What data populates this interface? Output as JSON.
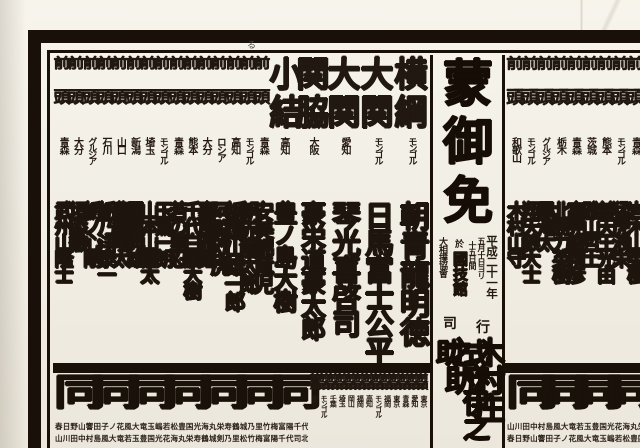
{
  "document": {
    "kind": "sumo-banzuke",
    "corner_mark": "る",
    "reading_order": "columns right-to-left; arrays below are in left-to-right display order"
  },
  "center": {
    "license": [
      "蒙",
      "御",
      "免"
    ],
    "date_line": "平成二十一年",
    "date_sub1": "五月十日ヨリ",
    "date_sub2": "十五日間",
    "venue_prefix": "於",
    "venue": "國技館",
    "organizer": "大相撲協會",
    "gyoji_label_right": "行",
    "gyoji_label_left": "司",
    "gyoji_right": "木村庄之助",
    "gyoji_left": "式守伊之助"
  },
  "west": {
    "side_note": "west half of makuuchi row, lowest rank at left edge",
    "columns": [
      {
        "rank": "前頭",
        "rt": "前",
        "rb": "頭",
        "origin": "青森",
        "name": "武州山隆士"
      },
      {
        "rank": "前頭",
        "rt": "前",
        "rb": "頭",
        "origin": "大分",
        "name": "垣添徹"
      },
      {
        "rank": "前頭",
        "rt": "前",
        "rb": "頭",
        "origin": "グルジア",
        "name": "栃ノ心剛"
      },
      {
        "rank": "前頭",
        "rt": "前",
        "rb": "頭",
        "origin": "石川",
        "name": "栃乃洋泰一"
      },
      {
        "rank": "前頭",
        "rt": "前",
        "rb": "頭",
        "origin": "山口",
        "name": "豊響隆太"
      },
      {
        "rank": "前頭",
        "rt": "前",
        "rb": "頭",
        "origin": "新潟",
        "name": "霜鳳典雄"
      },
      {
        "rank": "前頭",
        "rt": "前",
        "rb": "頭",
        "origin": "埼玉",
        "name": "山本山龍太"
      },
      {
        "rank": "前頭",
        "rt": "前",
        "rb": "頭",
        "origin": "モンゴル",
        "name": "玉鷲一朗"
      },
      {
        "rank": "前頭",
        "rt": "前",
        "rb": "頭",
        "origin": "青森",
        "name": "若の里忍"
      },
      {
        "rank": "前頭",
        "rt": "前",
        "rb": "頭",
        "origin": "熊本",
        "name": "千代白鵬大樹"
      },
      {
        "rank": "前頭",
        "rt": "前",
        "rb": "頭",
        "origin": "大分",
        "name": "嘉風雅継"
      },
      {
        "rank": "前頭",
        "rt": "前",
        "rb": "頭",
        "origin": "ロシア",
        "name": "阿覧欧虎"
      },
      {
        "rank": "前頭",
        "rt": "前",
        "rb": "頭",
        "origin": "高知",
        "name": "栃煌山雄一郎"
      },
      {
        "rank": "前頭",
        "rt": "前",
        "rb": "頭",
        "origin": "モンゴル",
        "name": "朝赤龍太郎"
      },
      {
        "rank": "前頭",
        "rt": "前",
        "rb": "頭",
        "origin": "青森",
        "name": "安美錦竜児"
      },
      {
        "rank": "小結",
        "rt": "小",
        "rb": "結",
        "origin": "高知",
        "name": "豊ノ島大樹"
      },
      {
        "rank": "関脇",
        "rt": "関",
        "rb": "脇",
        "origin": "大阪",
        "name": "豪栄道豪太郎"
      },
      {
        "rank": "大関",
        "rt": "大",
        "rb": "関",
        "origin": "愛知",
        "name": "琴光喜啓司"
      },
      {
        "rank": "大関",
        "rt": "大",
        "rb": "関",
        "origin": "モンゴル",
        "name": "日馬富士公平"
      },
      {
        "rank": "横綱",
        "rt": "横",
        "rb": "綱",
        "origin": "モンゴル",
        "name": "朝青龍明徳"
      }
    ]
  },
  "east": {
    "side_note": "east half, low maegashira adjacent to center strip; higher ranks cut off at right edge",
    "columns": [
      {
        "rank": "前頭",
        "rt": "前",
        "rb": "頭",
        "origin": "和歌山",
        "name": "木村山守"
      },
      {
        "rank": "前頭",
        "rt": "前",
        "rb": "頭",
        "origin": "モンゴル",
        "name": "翔天狼大士"
      },
      {
        "rank": "前頭",
        "rt": "前",
        "rb": "頭",
        "origin": "グルジア",
        "name": "黒海太"
      },
      {
        "rank": "前頭",
        "rt": "前",
        "rb": "頭",
        "origin": "栃木",
        "name": "北勝力英樹"
      },
      {
        "rank": "前頭",
        "rt": "前",
        "rb": "頭",
        "origin": "青森",
        "name": "高見盛精彦"
      },
      {
        "rank": "前頭",
        "rt": "前",
        "rb": "頭",
        "origin": "茨城",
        "name": "雅山哲士"
      },
      {
        "rank": "前頭",
        "rt": "前",
        "rb": "頭",
        "origin": "熊本",
        "name": "普天王光由"
      },
      {
        "rank": "前頭",
        "rt": "前",
        "rb": "頭",
        "origin": "モンゴル",
        "name": "猛虎浪栄"
      },
      {
        "rank": "前頭",
        "rt": "前",
        "rb": "頭",
        "origin": "青森",
        "name": "岩木山英樹"
      }
    ]
  },
  "second_band": {
    "ditto_mark": "同",
    "juryo_mark_top": "前",
    "juryo_mark_bottom": "頭",
    "juryo_origins": [
      "東京",
      "モンゴル",
      "千葉",
      "埼玉",
      "岡山",
      "福岡",
      "高知",
      "モンゴル",
      "福岡",
      "東京",
      "青森",
      "愛知",
      "東京"
    ],
    "fine_print_line1": "春日野山響田子ノ花風大竜玉嶋若松豊国光海丸栄寿鶴城乃里竹梅富陽千代司川村中島津軽山風大竜玉嶋若松豊国光",
    "fine_print_line2": "山川田中村島風大竜若玉豊国光花海丸栄寿鶴城剣乃里松竹梅富陽千代司北東西南春夏秋冬山川田中村島風大竜若玉豊"
  }
}
